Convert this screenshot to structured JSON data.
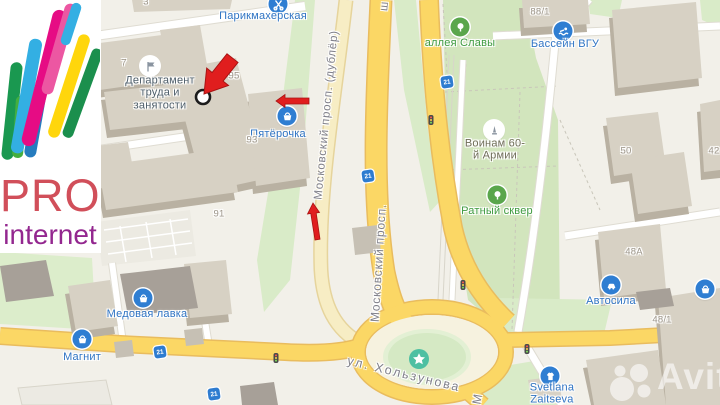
{
  "logo": {
    "title": "PRO",
    "subtitle": "internet",
    "title_color": "#d14f5a",
    "subtitle_color": "#93278f"
  },
  "watermark": {
    "brand": "Avito"
  },
  "map": {
    "colors": {
      "land": "#f2f0e9",
      "park_green": "#d5e7c1",
      "road_yellow": "#fbd765",
      "road_casing": "#e9bc5e",
      "white_road": "#ffffff",
      "building": "#d7d1c4",
      "building_dark": "#a7a098",
      "poi_blue": "#2f7ed2",
      "poi_green": "#5aa64c",
      "annotation_red": "#e01e1e",
      "star_circle_teal": "#4ec0a2",
      "tram_blue": "#2e7cd0"
    },
    "streets": {
      "dubler": "Московский просп. (дублёр)",
      "moskovsky": "Московский просп.",
      "kholzunova": "ул. Хользунова",
      "moskovsky_partial": "М",
      "top_partial": "ш"
    },
    "pois": [
      {
        "label": "Парикмахерская",
        "icon": "scissors-icon"
      },
      {
        "label": "Департамент\nтруда и\nзанятости",
        "icon": "flag-icon"
      },
      {
        "label": "Пятёрочка",
        "icon": "basket-icon"
      },
      {
        "label": "Медовая лавка",
        "icon": "basket-icon"
      },
      {
        "label": "Магнит",
        "icon": "basket-icon"
      },
      {
        "label": "Бассейн ВГУ",
        "icon": "swimmer-icon"
      },
      {
        "label": "аллея Славы",
        "icon": "tree-icon"
      },
      {
        "label": "Воинам 60-\nй Армии",
        "icon": "monument-icon"
      },
      {
        "label": "Ратный сквер",
        "icon": "tree-icon"
      },
      {
        "label": "Автосила",
        "icon": "car-icon"
      },
      {
        "label": "Svetlana\nZaitseva",
        "icon": "tshirt-icon"
      }
    ],
    "building_numbers": [
      "7",
      "95",
      "93",
      "91",
      "3",
      "88/1",
      "50",
      "48А",
      "42",
      "48/1"
    ],
    "tram_stop": "21"
  }
}
